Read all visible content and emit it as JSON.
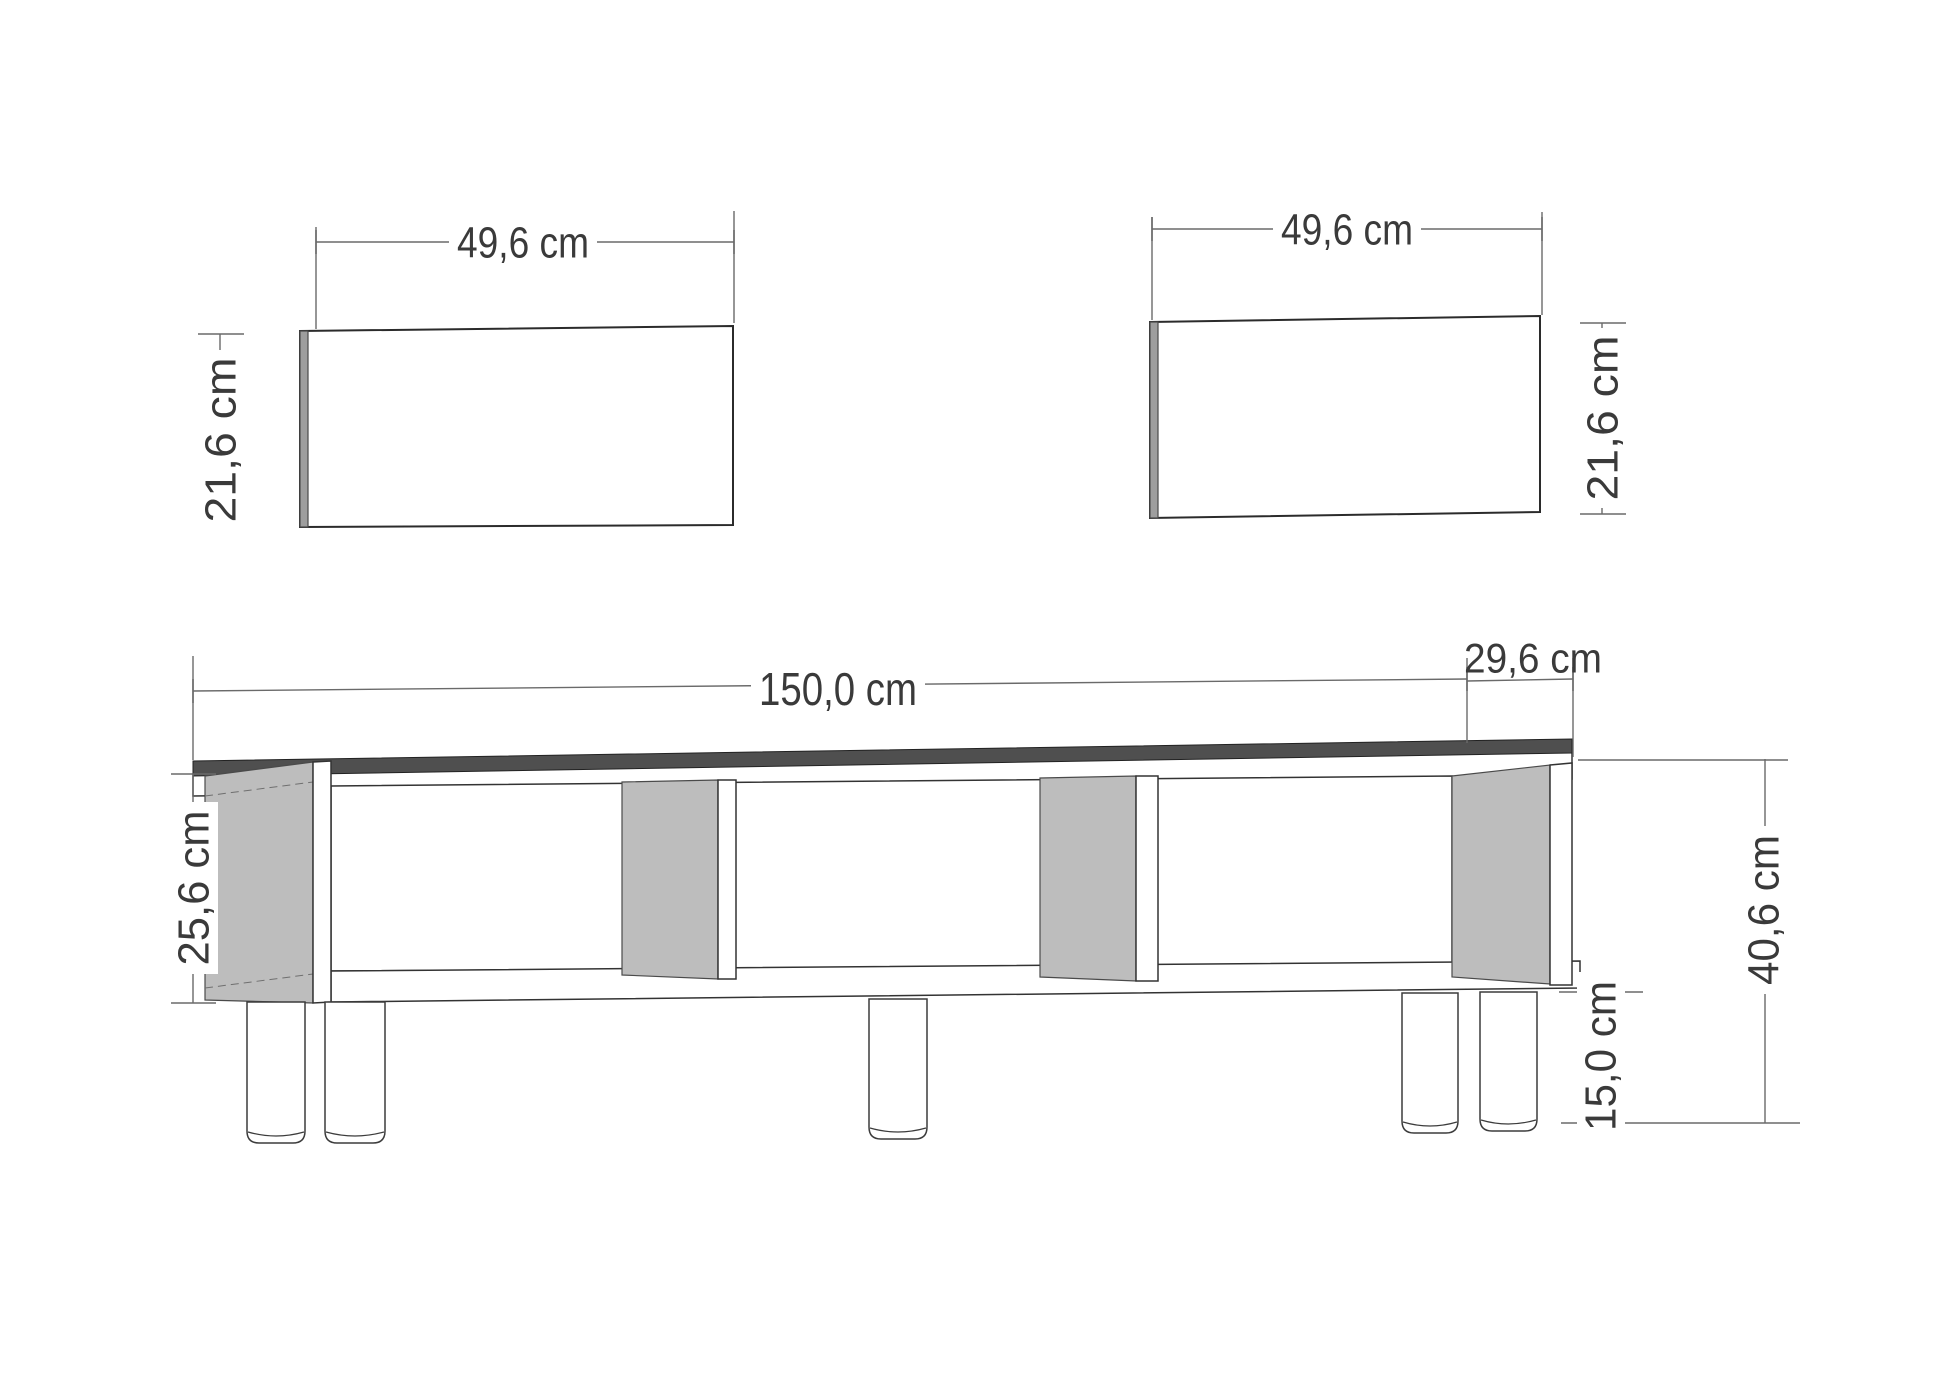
{
  "colors": {
    "background": "#ffffff",
    "outline": "#2b2b2b",
    "dim_line": "#6a6a6a",
    "label_text": "#3a3a3a",
    "panel_gray": "#bdbdbd",
    "edge_gray": "#9e9e9e",
    "top_dark": "#4f4f4f"
  },
  "panels": {
    "top_left": {
      "width_label": "49,6 cm",
      "height_label": "21,6 cm"
    },
    "top_right": {
      "width_label": "49,6 cm",
      "height_label": "21,6 cm"
    }
  },
  "cabinet": {
    "width_label": "150,0 cm",
    "depth_label": "29,6 cm",
    "body_height_label": "25,6 cm",
    "total_height_label": "40,6 cm",
    "leg_height_label": "15,0 cm"
  }
}
